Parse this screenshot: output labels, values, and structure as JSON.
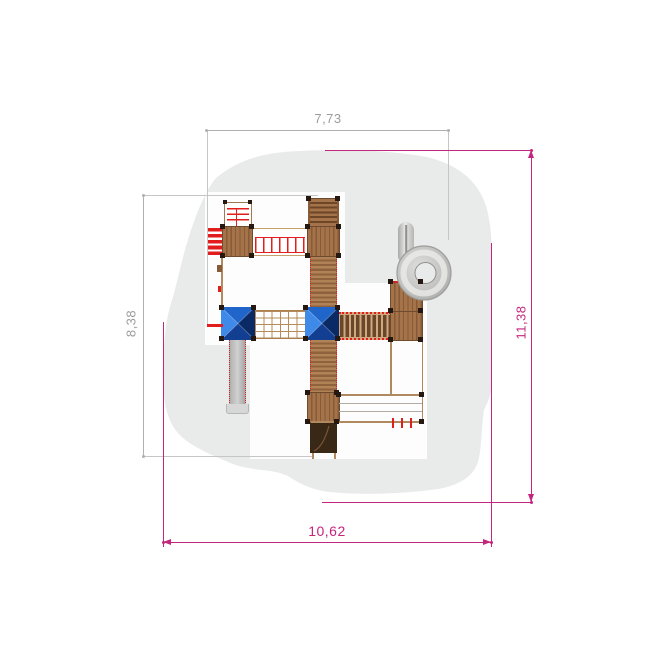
{
  "drawing": {
    "type": "playground-equipment-plan-top-view",
    "dimensions": {
      "top_width": "7,73",
      "left_height": "8,38",
      "right_height": "11,38",
      "bottom_width": "10,62"
    },
    "colors": {
      "dim_gray": "#9c9c9c",
      "dim_gray_line": "#b0b0b0",
      "dim_gray_ext": "#c6c6c6",
      "dim_magenta": "#c4267e",
      "safety_area": "#e9eaea",
      "white_zone": "#fdfdfd",
      "wood_light": "#a5734a",
      "wood_dark": "#875a38",
      "wood_edge": "#6e4a2e",
      "wood_tread": "#6d4628",
      "rail_tan": "#a97f4f",
      "rung_dark": "#6b462a",
      "rung_bg": "#cfa97e",
      "accent_red": "#e21d1d",
      "roof_top": "#2065c9",
      "roof_left": "#3f8ae8",
      "roof_right": "#0a2a66",
      "roof_bottom": "#133f93",
      "slide_silver": "#b9bab9",
      "slide_silver_light": "#d6d7d6",
      "slide_silver_dark": "#a0a1a0",
      "post_dark": "#241811",
      "panel_dark": "#3a2817"
    },
    "elements": [
      "safety-surface-area",
      "climbing-frame",
      "red-step-rungs",
      "wood-platform",
      "monkey-bar-ladder",
      "access-stairs",
      "ramp-walkway",
      "pyramid-roof-tower",
      "net-bridge",
      "rung-bridge",
      "spiral-tube-slide",
      "straight-slide",
      "balance-rope-frame",
      "dark-exit-panel"
    ]
  }
}
